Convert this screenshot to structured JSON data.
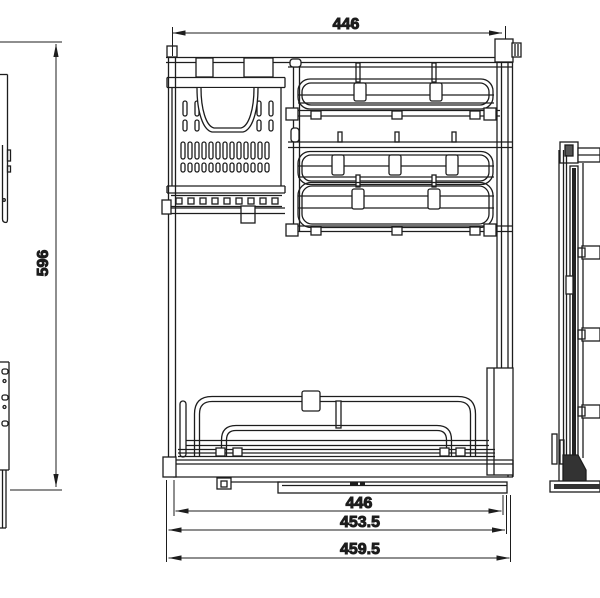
{
  "drawing": {
    "background": "#ffffff",
    "line_color": "#1d1d1d",
    "views": {
      "front": "front view",
      "left": "left side view (partial)",
      "right": "right side view (partial)"
    }
  },
  "dimensions": {
    "top_width": {
      "label": "446"
    },
    "height": {
      "label": "596"
    },
    "bottom_widths": [
      {
        "label": "446"
      },
      {
        "label": "453.5"
      },
      {
        "label": "459.5"
      }
    ]
  }
}
